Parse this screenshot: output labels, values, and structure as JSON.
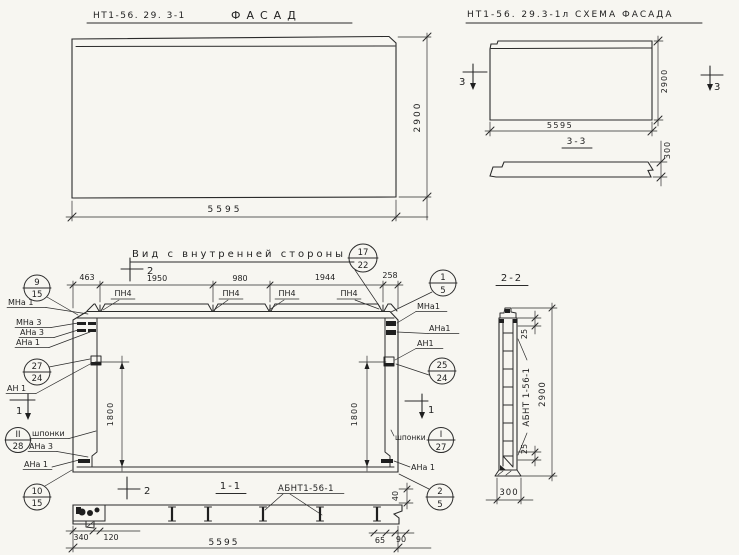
{
  "palette": {
    "paper": "#f7f6f1",
    "ink": "#2b2b2b"
  },
  "facade": {
    "code": "НТ1-56. 29. 3-1",
    "title": "ФАСАД",
    "dim_width": "5595",
    "dim_height": "2900"
  },
  "schema": {
    "title": "НТ1-56. 29.3-1л СХЕМА ФАСАДА",
    "dim_width": "5595",
    "dim_height": "2900",
    "section_title": "3-3",
    "dim_thickness": "300",
    "cut_mark": "3"
  },
  "inner_view": {
    "title": "Вид с внутренней стороны",
    "dims_top": [
      "463",
      "1950",
      "980",
      "1944",
      "258"
    ],
    "dim_left": "1800",
    "dim_right": "1800",
    "anchor_label": "ПН4",
    "cut_mark_vertical": "2",
    "cut_mark_horizontal": "1",
    "left_labels": {
      "mna1": "МНа 1",
      "mna3": "МНа 3",
      "ana3": "АНа 3",
      "ana1": "АНа 1",
      "an1": "АН 1",
      "keys": "шпонки",
      "ana3_bottom": "АНа 3",
      "ana1_bottom": "АНа 1"
    },
    "right_labels": {
      "mna1": "МНа1",
      "ana1": "АНа1",
      "an1": "АН1",
      "keys": "шпонки",
      "ana1_bottom": "АНа 1"
    },
    "callouts": {
      "top_right": {
        "num": "17",
        "den": "22"
      },
      "left_top": {
        "num": "9",
        "den": "15"
      },
      "left_mid": {
        "num": "27",
        "den": "24"
      },
      "left_keys": {
        "num": "II",
        "den": "28"
      },
      "left_bottom": {
        "num": "10",
        "den": "15"
      },
      "right_top": {
        "num": "1",
        "den": "5"
      },
      "right_mid": {
        "num": "25",
        "den": "24"
      },
      "right_keys": {
        "num": "I",
        "den": "27"
      },
      "right_bottom": {
        "num": "2",
        "den": "5"
      }
    }
  },
  "section11": {
    "title": "1-1",
    "part_label": "АБНТ1-56-1",
    "cut_mark": "2",
    "dim_340": "340",
    "dim_120": "120",
    "dim_width": "5595",
    "dim_65": "65",
    "dim_90": "90",
    "dim_40": "40"
  },
  "section22": {
    "title": "2-2",
    "part_label": "АБНТ 1-56-1",
    "dim_25_top": "25",
    "dim_25_bottom": "25",
    "dim_height": "2900",
    "dim_width": "300"
  }
}
